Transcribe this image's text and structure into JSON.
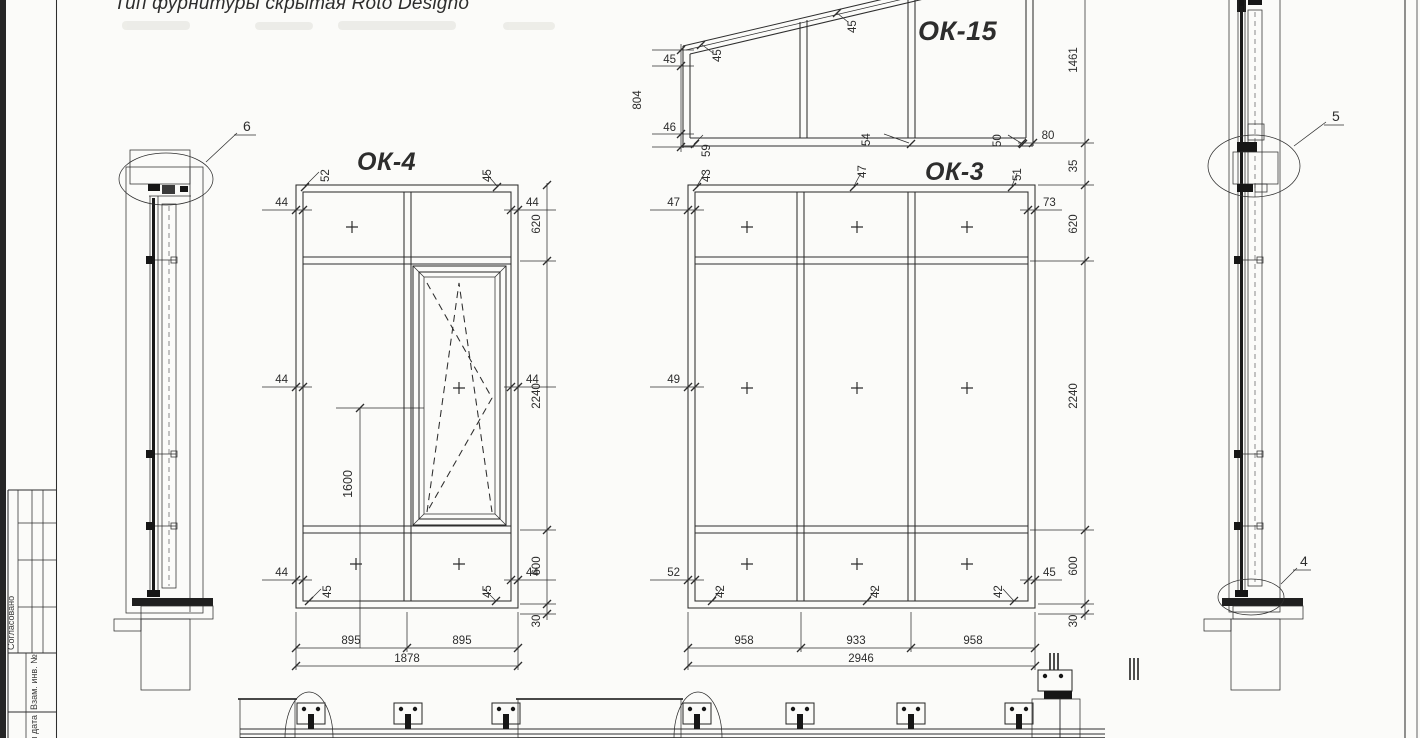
{
  "palette": {
    "paper": "#fbfbf9",
    "ink": "#2e2e2e",
    "dark_fill": "#161616"
  },
  "note": {
    "text": "Тип фурнитуры скрытая Roto Designo"
  },
  "windows": {
    "ok4": {
      "label": "ОК-4",
      "top_leaders": [
        "52",
        "45"
      ],
      "left_profile": [
        "44",
        "44",
        "44"
      ],
      "right_profile": [
        "44",
        "44",
        "44"
      ],
      "bottom_leaders": [
        "45",
        "45"
      ],
      "height_chain": [
        "620",
        "2240",
        "600",
        "30"
      ],
      "widths": [
        "895",
        "895"
      ],
      "total_width": "1878",
      "handle_height": "1600"
    },
    "ok3": {
      "label": "ОК-3",
      "top_leaders": [
        "43",
        "47",
        "51"
      ],
      "left_profile": [
        "47",
        "49",
        "52"
      ],
      "right_profile_top": "73",
      "right_profile_bottom": "45",
      "bottom_leaders": [
        "42",
        "42",
        "42"
      ],
      "height_chain": [
        "620",
        "2240",
        "600",
        "30"
      ],
      "gap_to_ok15": "35",
      "widths": [
        "958",
        "933",
        "958"
      ],
      "total_width": "2946"
    },
    "ok15": {
      "label": "ОК-15",
      "left_chain": [
        "45",
        "804",
        "46"
      ],
      "slope_leaders": [
        "45",
        "45"
      ],
      "bottom_leaders": [
        "59",
        "54",
        "50"
      ],
      "frame_dim": "80",
      "right_height": "1461"
    }
  },
  "callouts": {
    "top_left": "6",
    "right_middle": "5",
    "right_bottom": "4"
  },
  "title_block": {
    "approved": "Согласовано",
    "substitute": "Взам. инв. №",
    "sign_date": "Подп. и дата"
  }
}
